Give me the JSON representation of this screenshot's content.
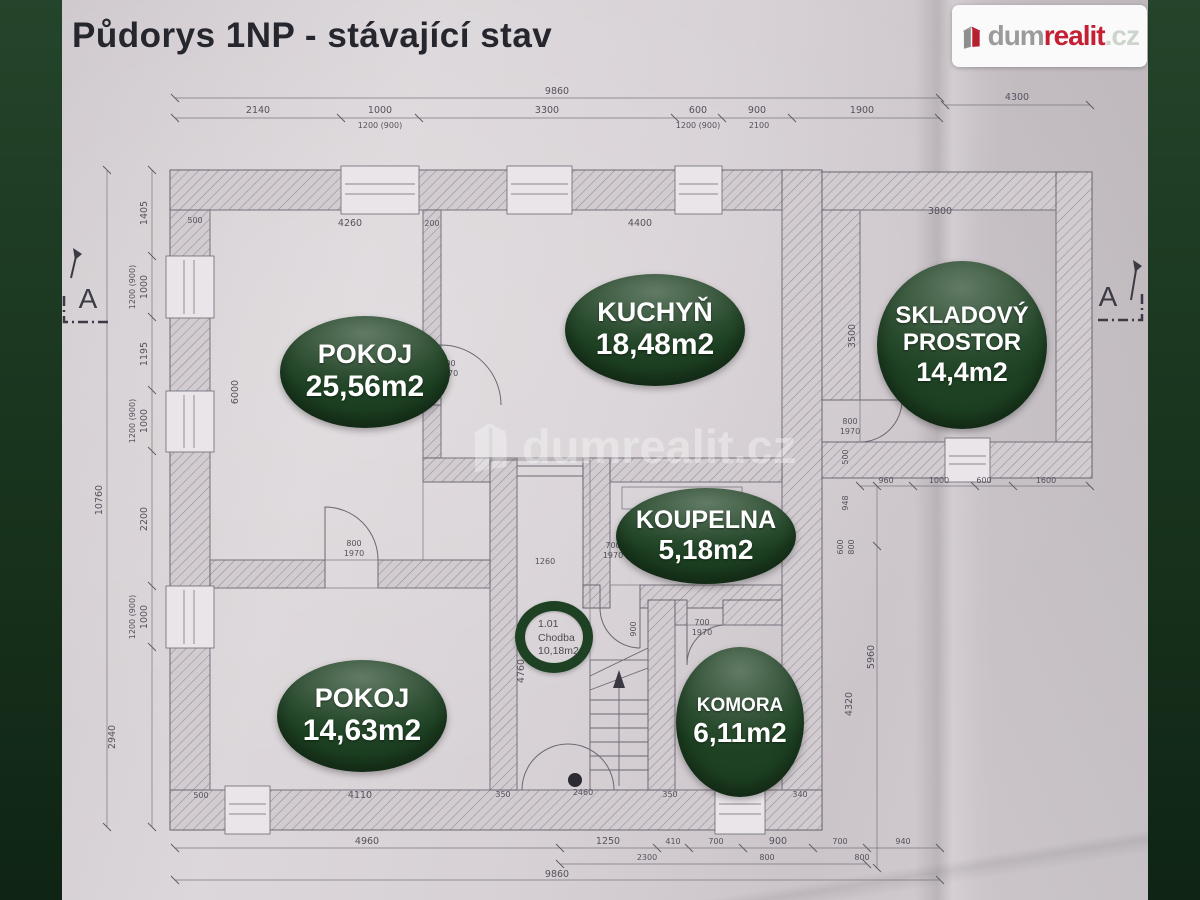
{
  "header": {
    "title": "Půdorys 1NP - stávající stav"
  },
  "logo": {
    "brand_dum": "dum",
    "brand_realit": "realit",
    "brand_cz": ".cz"
  },
  "watermark": {
    "text": "dumrealit.cz"
  },
  "colors": {
    "frame_green": "#1d3a22",
    "badge_green": "#1d4122",
    "logo_red": "#c41f33",
    "logo_gray": "#9b9b9b",
    "paper": "#d6d0d4"
  },
  "badges": {
    "pokoj1": {
      "name": "POKOJ",
      "area": "25,56m2"
    },
    "kuchyn": {
      "name": "KUCHYŇ",
      "area": "18,48m2"
    },
    "sklad": {
      "name_line1": "SKLADOVÝ",
      "name_line2": "PROSTOR",
      "area": "14,4m2"
    },
    "koupelna": {
      "name": "KOUPELNA",
      "area": "5,18m2"
    },
    "pokoj2": {
      "name": "POKOJ",
      "area": "14,63m2"
    },
    "komora": {
      "name": "KOMORA",
      "area": "6,11m2"
    },
    "chodba": {
      "number": "1.01",
      "name": "Chodba",
      "area": "10,18m2"
    }
  },
  "section_markers": {
    "left": "A",
    "right": "A"
  },
  "plan": {
    "dimension_labels": [
      {
        "text": "9860",
        "x": 495,
        "y": 94
      },
      {
        "text": "2140",
        "x": 196,
        "y": 113
      },
      {
        "text": "1000",
        "x": 318,
        "y": 113
      },
      {
        "text": "3300",
        "x": 485,
        "y": 113
      },
      {
        "text": "600",
        "x": 636,
        "y": 113
      },
      {
        "text": "900",
        "x": 695,
        "y": 113
      },
      {
        "text": "1900",
        "x": 800,
        "y": 113
      },
      {
        "text": "1200 (900)",
        "x": 318,
        "y": 128,
        "s": 1
      },
      {
        "text": "1200 (900)",
        "x": 636,
        "y": 128,
        "s": 1
      },
      {
        "text": "2100",
        "x": 697,
        "y": 128,
        "s": 1
      },
      {
        "text": "4300",
        "x": 955,
        "y": 100
      },
      {
        "text": "10760",
        "x": 40,
        "y": 500,
        "r": -90
      },
      {
        "text": "1405",
        "x": 85,
        "y": 213,
        "r": -90
      },
      {
        "text": "1000",
        "x": 85,
        "y": 287,
        "r": -90
      },
      {
        "text": "1200 (900)",
        "x": 73,
        "y": 287,
        "r": -90,
        "s": 1
      },
      {
        "text": "1195",
        "x": 85,
        "y": 354,
        "r": -90
      },
      {
        "text": "1000",
        "x": 85,
        "y": 421,
        "r": -90
      },
      {
        "text": "1200 (900)",
        "x": 73,
        "y": 421,
        "r": -90,
        "s": 1
      },
      {
        "text": "2200",
        "x": 85,
        "y": 519,
        "r": -90
      },
      {
        "text": "1000",
        "x": 85,
        "y": 617,
        "r": -90
      },
      {
        "text": "1200 (900)",
        "x": 73,
        "y": 617,
        "r": -90,
        "s": 1
      },
      {
        "text": "2940",
        "x": 53,
        "y": 737,
        "r": -90
      },
      {
        "text": "4960",
        "x": 305,
        "y": 844
      },
      {
        "text": "1250",
        "x": 546,
        "y": 844
      },
      {
        "text": "410",
        "x": 611,
        "y": 844,
        "s": 1
      },
      {
        "text": "700",
        "x": 654,
        "y": 844,
        "s": 1
      },
      {
        "text": "900",
        "x": 716,
        "y": 844
      },
      {
        "text": "700",
        "x": 778,
        "y": 844,
        "s": 1
      },
      {
        "text": "940",
        "x": 841,
        "y": 844,
        "s": 1
      },
      {
        "text": "2300",
        "x": 585,
        "y": 860,
        "s": 1
      },
      {
        "text": "800",
        "x": 705,
        "y": 860,
        "s": 1
      },
      {
        "text": "800",
        "x": 800,
        "y": 860,
        "s": 1
      },
      {
        "text": "9860",
        "x": 495,
        "y": 877
      },
      {
        "text": "3800",
        "x": 878,
        "y": 214
      },
      {
        "text": "3500",
        "x": 793,
        "y": 336,
        "r": -90
      },
      {
        "text": "960",
        "x": 824,
        "y": 483,
        "s": 1
      },
      {
        "text": "1000",
        "x": 877,
        "y": 483,
        "s": 1
      },
      {
        "text": "600",
        "x": 922,
        "y": 483,
        "s": 1
      },
      {
        "text": "1600",
        "x": 984,
        "y": 483,
        "s": 1
      },
      {
        "text": "500",
        "x": 786,
        "y": 457,
        "r": -90,
        "s": 1
      },
      {
        "text": "948",
        "x": 786,
        "y": 503,
        "r": -90,
        "s": 1
      },
      {
        "text": "600",
        "x": 781,
        "y": 547,
        "r": -90,
        "s": 1
      },
      {
        "text": "800",
        "x": 792,
        "y": 547,
        "r": -90,
        "s": 1
      },
      {
        "text": "5960",
        "x": 812,
        "y": 657,
        "r": -90
      },
      {
        "text": "4320",
        "x": 790,
        "y": 704,
        "r": -90
      },
      {
        "text": "4260",
        "x": 288,
        "y": 226
      },
      {
        "text": "200",
        "x": 370,
        "y": 226,
        "s": 1
      },
      {
        "text": "4400",
        "x": 578,
        "y": 226
      },
      {
        "text": "500",
        "x": 133,
        "y": 223,
        "s": 1
      },
      {
        "text": "4200",
        "x": 551,
        "y": 332,
        "r": -90
      },
      {
        "text": "6000",
        "x": 176,
        "y": 392,
        "r": -90
      },
      {
        "text": "800",
        "x": 386,
        "y": 366,
        "s": 1
      },
      {
        "text": "1970",
        "x": 386,
        "y": 376,
        "s": 1
      },
      {
        "text": "800",
        "x": 292,
        "y": 546,
        "s": 1
      },
      {
        "text": "1970",
        "x": 292,
        "y": 556,
        "s": 1
      },
      {
        "text": "800",
        "x": 788,
        "y": 424,
        "s": 1
      },
      {
        "text": "1970",
        "x": 788,
        "y": 434,
        "s": 1
      },
      {
        "text": "700",
        "x": 551,
        "y": 548,
        "s": 1
      },
      {
        "text": "1970",
        "x": 551,
        "y": 558,
        "s": 1
      },
      {
        "text": "700",
        "x": 640,
        "y": 625,
        "s": 1
      },
      {
        "text": "1970",
        "x": 640,
        "y": 635,
        "s": 1
      },
      {
        "text": "1260",
        "x": 483,
        "y": 564,
        "s": 1
      },
      {
        "text": "900",
        "x": 574,
        "y": 629,
        "r": -90,
        "s": 1
      },
      {
        "text": "4760",
        "x": 462,
        "y": 671,
        "r": -90
      },
      {
        "text": "2460",
        "x": 521,
        "y": 795,
        "s": 1
      },
      {
        "text": "4110",
        "x": 298,
        "y": 798
      },
      {
        "text": "500",
        "x": 139,
        "y": 798,
        "s": 1
      },
      {
        "text": "350",
        "x": 441,
        "y": 797,
        "s": 1
      },
      {
        "text": "350",
        "x": 608,
        "y": 797,
        "s": 1
      },
      {
        "text": "1750",
        "x": 673,
        "y": 795,
        "s": 1
      },
      {
        "text": "340",
        "x": 738,
        "y": 797,
        "s": 1
      }
    ]
  }
}
